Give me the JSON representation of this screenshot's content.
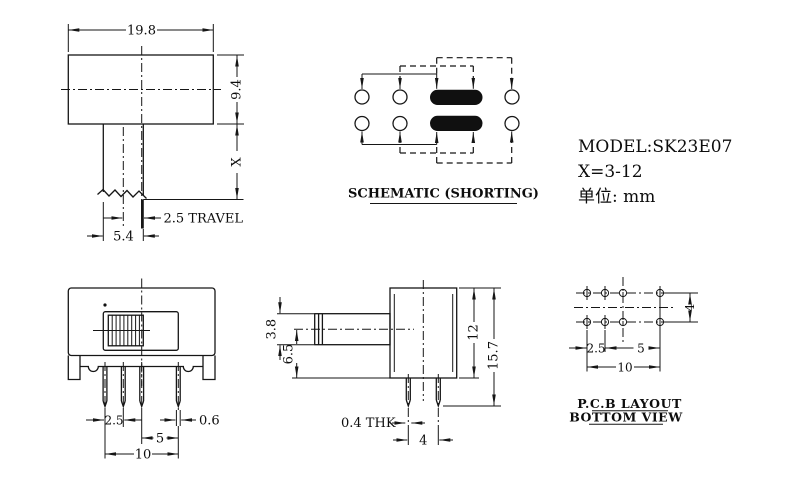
{
  "top_view": {
    "dim_width": "19.8",
    "dim_height": "9.4",
    "dim_stem": "X",
    "dim_travel": "2.5 TRAVEL",
    "dim_stem_width": "5.4"
  },
  "schematic": {
    "title": "SCHEMATIC (SHORTING)"
  },
  "info": {
    "model": "MODEL:SK23E07",
    "x_range": "X=3-12",
    "unit": "单位: mm"
  },
  "front_view": {
    "dim_pitch": "2.5",
    "dim_pin_width": "0.6",
    "dim_pitch_wide": "5",
    "dim_total": "10"
  },
  "side_view": {
    "dim_handle": "3.8",
    "dim_center_height": "6.5",
    "dim_body": "12",
    "dim_total": "15.7",
    "dim_thickness": "0.4 THK",
    "dim_pin_gap": "4"
  },
  "pcb": {
    "dim_rows": "4",
    "dim_pitch": "2.5",
    "dim_pitch_wide": "5",
    "dim_total": "10",
    "title_line1": "P.C.B LAYOUT",
    "title_line2": "BOTTOM VIEW"
  }
}
